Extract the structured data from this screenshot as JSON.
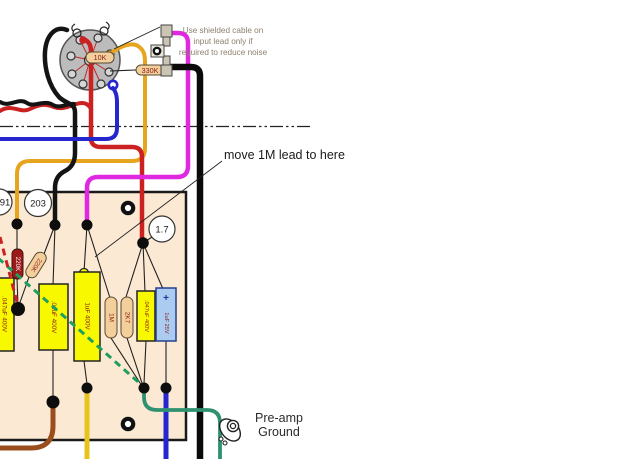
{
  "diagram": {
    "type": "tube-amp-wiring-layout",
    "annotations": {
      "shielded_note_line1": "Use shielded cable on",
      "shielded_note_line2": "input lead only if",
      "shielded_note_line3": "required to reduce noise",
      "move_lead_note": "move 1M lead to here",
      "preamp_ground_line1": "Pre-amp",
      "preamp_ground_line2": "Ground"
    },
    "test_point_labels": {
      "tp_91": "91",
      "tp_203": "203",
      "tp_1_7": "1.7"
    },
    "component_labels": {
      "socket_resistor": "10K",
      "input_resistor": "330K",
      "plate_resistor_dark": "220K",
      "plate_resistor_tan": "220K",
      "cap_left_edge": ".047uF 400V",
      "coupling_cap_01": ".01uF 400V",
      "cap_1uf_400": "1uF 400V",
      "grid_resistor_1m": "1M",
      "cathode_resistor_2k7": "2K7",
      "coupling_cap_047": ".047uF 400V",
      "bypass_cap": "1uF 25V",
      "bypass_cap_polarity": "+"
    },
    "wire_colors": {
      "gold": "#e7a41f",
      "red": "#cc2121",
      "black": "#0a0a0a",
      "blue": "#2626cf",
      "magenta": "#e128e1",
      "teal": "#2e9170",
      "brown": "#9a4d1d",
      "yellow": "#e7c41c",
      "green_dashed_bus": "#1f9e5e",
      "red_dashed_bus": "#cc2121"
    },
    "board_color": "#fce9d3",
    "capacitor_yellow": "#f8f800",
    "electrolytic_blue": "#abcbf0",
    "resistor_tan": "#f2cf9b",
    "resistor_dark_red": "#9c1a1a"
  }
}
